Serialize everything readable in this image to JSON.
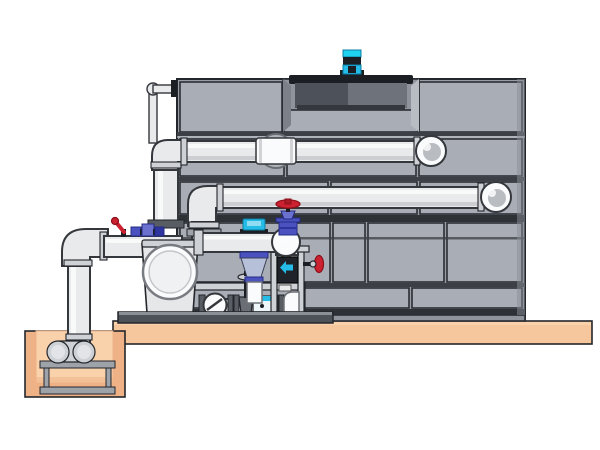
{
  "meta": {
    "title": "Technical illustration of a closed-circuit cooling tower installation with pump skid, distribution piping, concrete slab and sump pit",
    "type": "technical-illustration",
    "visible_text": []
  },
  "colors": {
    "background": "#ffffff",
    "panel_base": "#999da5",
    "panel_face": "#a9adb5",
    "panel_face_light": "#b8bcc3",
    "panel_recess": "#8f939b",
    "panel_edge_dark": "#7c8088",
    "panel_stroke": "#2b2e34",
    "outline": "#23262b",
    "rail_dark": "#3c4046",
    "basin_dark": "#2e3237",
    "edge_dark": "#1f2227",
    "cowl_dark": "#4d515a",
    "cowl_light": "#8a8e96",
    "cowl_lip": "#34383e",
    "dark_metal": "#1b1e22",
    "pipe_fill": "#e9eaec",
    "pipe_shade": "#bfc2c6",
    "pipe_white": "#fafbfc",
    "pipe_outline": "#34373c",
    "white_pipe_stroke": "#6f7378",
    "bulb_inner": "#b9bcc1",
    "port_fill": "#b0b3b9",
    "port_stroke": "#696d74",
    "steel_light": "#ced1d5",
    "steel_mid": "#9ea2a9",
    "steel_inner": "#e2e4e7",
    "steel_dark": "#6a6e75",
    "flange_dark": "#585c63",
    "tank_face": "#e6e7e9",
    "tank_port_stroke": "#787c82",
    "tank_port_inner": "#f0f1f3",
    "tank_port_inner_stroke": "#c3c6ca",
    "box_light": "#eef6fa",
    "dark_box": "#202329",
    "tag_stroke": "#555555",
    "skid_dark": "#4d5158",
    "skid_top": "#8b8f96",
    "concrete": "#f6c69c",
    "concrete_dark": "#efb287",
    "concrete_light": "#f9d2ac",
    "valve_red": "#cc2130",
    "valve_red_dark": "#8c1019",
    "red_hub": "#a81a26",
    "valve_blue": "#4a52c0",
    "valve_blue_dark": "#262c86",
    "valve_blue_light": "#6a71cf",
    "valve_blue_deep": "#2e359f",
    "cone_fill": "#b6c0d8",
    "cone_stroke": "#3c4258",
    "accent_cyan": "#25bde8",
    "accent_cyan_bright": "#1fd3ef",
    "accent_cyan_dark": "#0c7da3",
    "cyan_window": "#8fdcf2"
  },
  "components": [
    {
      "id": "cooling-tower",
      "label": "Cooling tower casing clad with rectangular gray panels"
    },
    {
      "id": "fan-cowl",
      "label": "Dark fan cowl recessed into the tower roof"
    },
    {
      "id": "fan-motor",
      "label": "Cyan fan motor mounted on top of the cowl"
    },
    {
      "id": "upper-distribution-pipe",
      "label": "Upper horizontal distribution pipe with left elbow, wall coupling and right end elbow"
    },
    {
      "id": "lower-distribution-pipe",
      "label": "Lower horizontal distribution pipe with left elbow and right end elbow"
    },
    {
      "id": "upper-riser-pipe",
      "label": "Vertical riser from upper pipe down to suction line"
    },
    {
      "id": "lower-riser-pipe",
      "label": "Vertical riser from lower pipe down to discharge header"
    },
    {
      "id": "makeup-water-pipe",
      "label": "Small-bore make-up water pipe entering tower at top left"
    },
    {
      "id": "suction-line",
      "label": "Large suction pipe with elbow dropping into the sump pit"
    },
    {
      "id": "ball-valve-red",
      "label": "Small red-lever ball valve tapped on the suction pipe"
    },
    {
      "id": "instrument-fittings-blue",
      "label": "Blue instrument fittings on the suction pipe"
    },
    {
      "id": "concrete-slab",
      "label": "Concrete foundation slab"
    },
    {
      "id": "sump-pit",
      "label": "Concrete sump pit below grade"
    },
    {
      "id": "sump-pump",
      "label": "Horizontal pump set on a stand inside the sump pit"
    },
    {
      "id": "strainer-tank",
      "label": "Pump/strainer housing with large circular inspection cover"
    },
    {
      "id": "discharge-header",
      "label": "Discharge header pipe with end dome elbow"
    },
    {
      "id": "flow-sensor",
      "label": "Cyan flow sensor on the discharge header"
    },
    {
      "id": "control-valve",
      "label": "Blue-trim control valve below the header"
    },
    {
      "id": "check-valve",
      "label": "Swing check valve (circle with diagonal) on the bottom run"
    },
    {
      "id": "gate-valve",
      "label": "Gate valve with rising stem and small handwheel"
    },
    {
      "id": "dosing-unit",
      "label": "Small cyan-striped inline unit on the bottom run"
    },
    {
      "id": "handwheel-valve-top",
      "label": "Red handwheel valve with blue body on the header elbow"
    },
    {
      "id": "handwheel-valve-side",
      "label": "Red handwheel valve facing right on the equipment stand"
    },
    {
      "id": "equipment-stand",
      "label": "Stand with dark controller box and cyan arrow"
    },
    {
      "id": "skid-base",
      "label": "Dark pump-skid base rail on the slab"
    }
  ]
}
